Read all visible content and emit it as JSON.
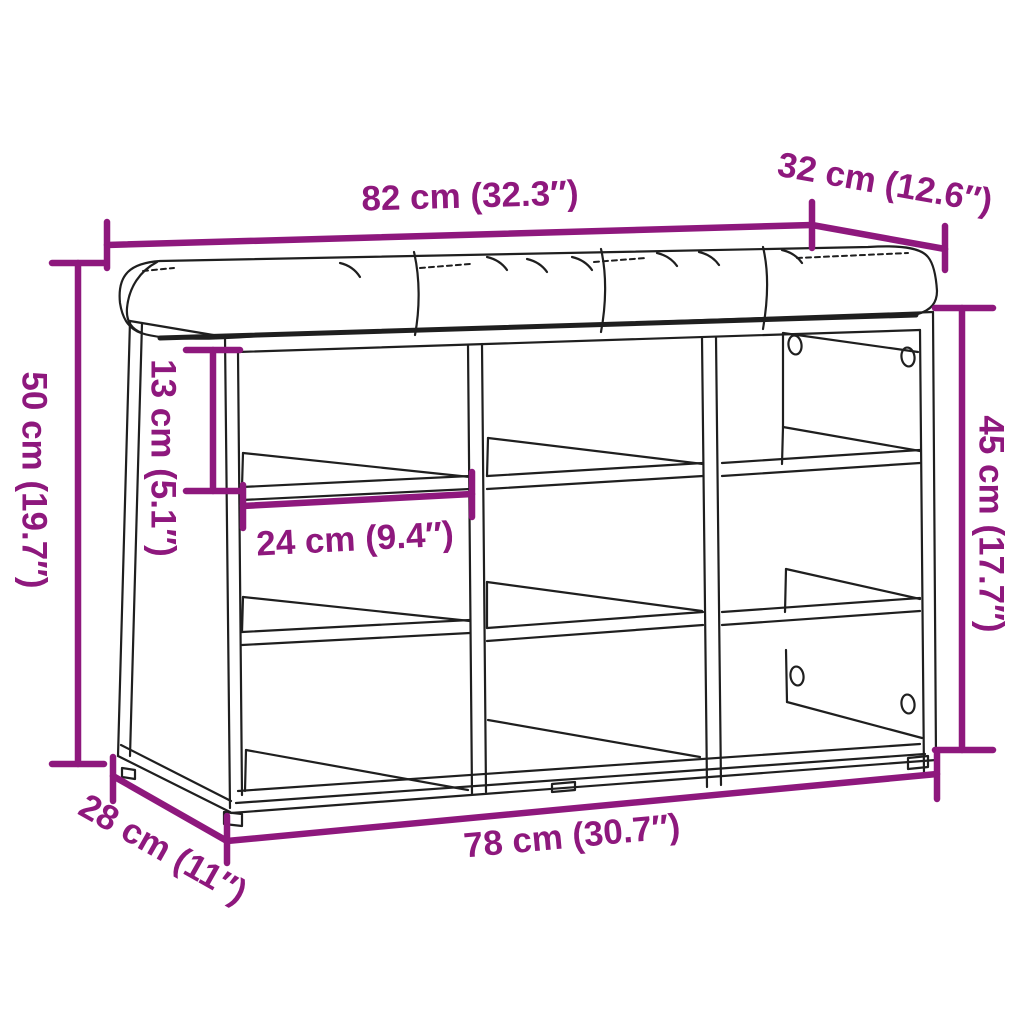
{
  "diagram": {
    "product": "Shoe storage bench with cushion and nine compartments",
    "background_color": "#ffffff",
    "line_color": "#1f1f1f",
    "accent_color": "#8E187D",
    "dimensions": {
      "overall_width": {
        "label": "82 cm (32.3″)"
      },
      "overall_depth": {
        "label": "32 cm (12.6″)"
      },
      "overall_height": {
        "label": "50 cm (19.7″)"
      },
      "compartment_height": {
        "label": "13 cm (5.1″)"
      },
      "compartment_width": {
        "label": "24 cm (9.4″)"
      },
      "interior_height": {
        "label": "45 cm (17.7″)"
      },
      "base_depth": {
        "label": "28 cm (11″)"
      },
      "base_width": {
        "label": "78 cm (30.7″)"
      }
    }
  }
}
